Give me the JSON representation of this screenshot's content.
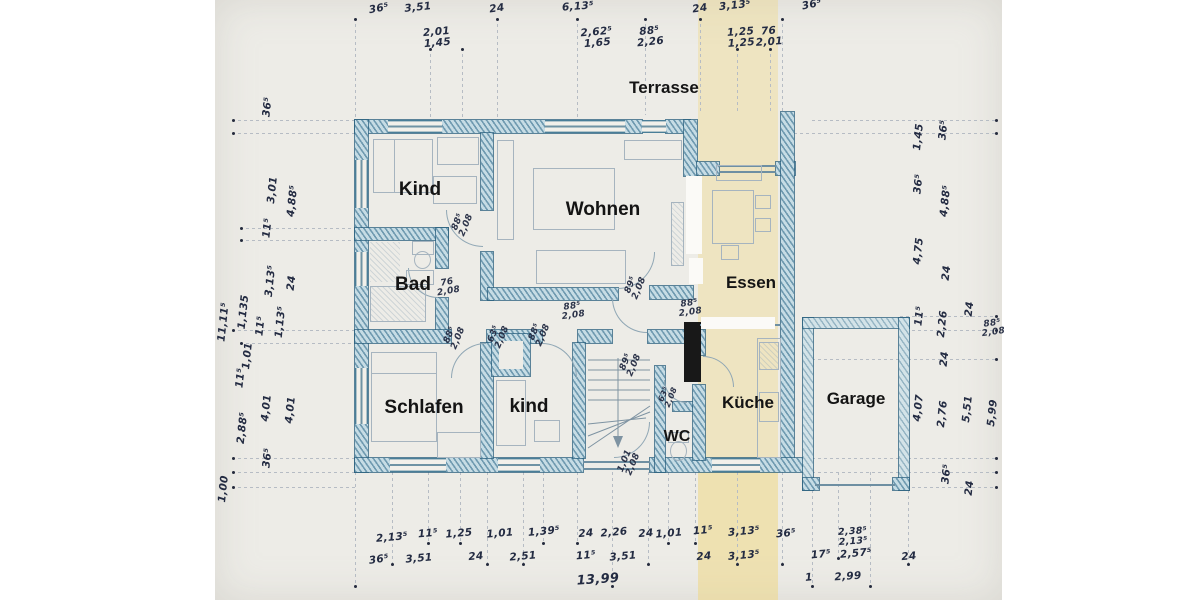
{
  "document_type": "scanned hand-drawn floor plan",
  "colors": {
    "paper": "#edece7",
    "margin": "#ffffff",
    "wall_ink": "#2f6b8a",
    "wall_fill": "#cfe0e8",
    "handwriting_ink": "#232b42",
    "pencil": "#a6b4bf",
    "room_text": "#141414",
    "highlight_strip": "#eed884",
    "chimney": "#181818"
  },
  "labels": {
    "rooms": [
      {
        "id": "terrasse",
        "t": "Terrasse",
        "x": 664,
        "y": 88,
        "s": 17
      },
      {
        "id": "kind-1",
        "t": "Kind",
        "x": 420,
        "y": 190,
        "s": 19
      },
      {
        "id": "wohnen",
        "t": "Wohnen",
        "x": 603,
        "y": 210,
        "s": 19
      },
      {
        "id": "essen",
        "t": "Essen",
        "x": 751,
        "y": 283,
        "s": 17
      },
      {
        "id": "bad",
        "t": "Bad",
        "x": 413,
        "y": 285,
        "s": 19
      },
      {
        "id": "schlafen",
        "t": "Schlafen",
        "x": 424,
        "y": 408,
        "s": 19
      },
      {
        "id": "kind-2",
        "t": "kind",
        "x": 529,
        "y": 407,
        "s": 19
      },
      {
        "id": "wc",
        "t": "WC",
        "x": 677,
        "y": 437,
        "s": 16
      },
      {
        "id": "kueche",
        "t": "Küche",
        "x": 748,
        "y": 403,
        "s": 17
      },
      {
        "id": "garage",
        "t": "Garage",
        "x": 856,
        "y": 399,
        "s": 17
      }
    ],
    "dims": [
      {
        "t": "36⁵",
        "x": 379,
        "y": 9,
        "r": -10
      },
      {
        "t": "3,51",
        "x": 418,
        "y": 8,
        "r": -6
      },
      {
        "t": "24",
        "x": 497,
        "y": 9,
        "r": -8
      },
      {
        "t": "6,13⁵",
        "x": 578,
        "y": 7,
        "r": -4
      },
      {
        "t": "24",
        "x": 700,
        "y": 9,
        "r": -8
      },
      {
        "t": "3,13⁵",
        "x": 735,
        "y": 6,
        "r": -6
      },
      {
        "t": "36⁵",
        "x": 812,
        "y": 5,
        "r": -12
      },
      {
        "t": "2,01\n1,45",
        "x": 437,
        "y": 38,
        "r": -5
      },
      {
        "t": "2,62⁵\n1,65",
        "x": 597,
        "y": 38,
        "r": -5
      },
      {
        "t": "88⁵\n2,26",
        "x": 650,
        "y": 37,
        "r": -6
      },
      {
        "t": "1,25\n1,25",
        "x": 741,
        "y": 38,
        "r": -4
      },
      {
        "t": "76\n2,01",
        "x": 769,
        "y": 37,
        "r": -4
      },
      {
        "t": "36⁵",
        "x": 268,
        "y": 107,
        "r": -84
      },
      {
        "t": "3,01",
        "x": 273,
        "y": 190,
        "r": -84
      },
      {
        "t": "4,88⁵",
        "x": 293,
        "y": 201,
        "r": -84
      },
      {
        "t": "11⁵",
        "x": 268,
        "y": 228,
        "r": -84
      },
      {
        "t": "3,13⁵",
        "x": 271,
        "y": 281,
        "r": -84
      },
      {
        "t": "24",
        "x": 292,
        "y": 283,
        "r": -84
      },
      {
        "t": "11,11⁵",
        "x": 224,
        "y": 322,
        "r": -84
      },
      {
        "t": "1,135",
        "x": 244,
        "y": 312,
        "r": -84
      },
      {
        "t": "11⁵",
        "x": 261,
        "y": 326,
        "r": -84
      },
      {
        "t": "1,13⁵",
        "x": 281,
        "y": 322,
        "r": -84
      },
      {
        "t": "1,01",
        "x": 248,
        "y": 356,
        "r": -84
      },
      {
        "t": "11⁵",
        "x": 241,
        "y": 378,
        "r": -84
      },
      {
        "t": "2,88⁵",
        "x": 243,
        "y": 428,
        "r": -84
      },
      {
        "t": "4,01",
        "x": 267,
        "y": 408,
        "r": -84
      },
      {
        "t": "4,01",
        "x": 291,
        "y": 410,
        "r": -84
      },
      {
        "t": "36⁵",
        "x": 268,
        "y": 458,
        "r": -84
      },
      {
        "t": "1,00",
        "x": 224,
        "y": 489,
        "r": -84
      },
      {
        "t": "1,45",
        "x": 919,
        "y": 137,
        "r": -84
      },
      {
        "t": "36⁵",
        "x": 944,
        "y": 130,
        "r": -84
      },
      {
        "t": "36⁵",
        "x": 919,
        "y": 184,
        "r": -84
      },
      {
        "t": "4,88⁵",
        "x": 946,
        "y": 201,
        "r": -84
      },
      {
        "t": "4,75",
        "x": 919,
        "y": 251,
        "r": -84
      },
      {
        "t": "24",
        "x": 947,
        "y": 273,
        "r": -84
      },
      {
        "t": "11⁵",
        "x": 920,
        "y": 316,
        "r": -84
      },
      {
        "t": "2,26",
        "x": 943,
        "y": 324,
        "r": -84
      },
      {
        "t": "24",
        "x": 970,
        "y": 309,
        "r": -84
      },
      {
        "t": "24",
        "x": 945,
        "y": 359,
        "r": -84
      },
      {
        "t": "4,07",
        "x": 919,
        "y": 408,
        "r": -84
      },
      {
        "t": "2,76",
        "x": 943,
        "y": 414,
        "r": -84
      },
      {
        "t": "5,51",
        "x": 968,
        "y": 409,
        "r": -84
      },
      {
        "t": "5,99",
        "x": 993,
        "y": 413,
        "r": -84
      },
      {
        "t": "36⁵",
        "x": 947,
        "y": 474,
        "r": -84
      },
      {
        "t": "24",
        "x": 970,
        "y": 488,
        "r": -84
      },
      {
        "t": "2,13⁵",
        "x": 392,
        "y": 538,
        "r": -5
      },
      {
        "t": "11⁵",
        "x": 428,
        "y": 534,
        "r": -5
      },
      {
        "t": "1,25",
        "x": 459,
        "y": 534,
        "r": -5
      },
      {
        "t": "1,01",
        "x": 500,
        "y": 534,
        "r": -5
      },
      {
        "t": "1,39⁵",
        "x": 544,
        "y": 532,
        "r": -5
      },
      {
        "t": "24",
        "x": 586,
        "y": 534,
        "r": -5
      },
      {
        "t": "2,26",
        "x": 614,
        "y": 533,
        "r": -5
      },
      {
        "t": "24",
        "x": 646,
        "y": 534,
        "r": -5
      },
      {
        "t": "1,01",
        "x": 669,
        "y": 534,
        "r": -5
      },
      {
        "t": "11⁵",
        "x": 703,
        "y": 531,
        "r": -5
      },
      {
        "t": "3,13⁵",
        "x": 744,
        "y": 532,
        "r": -5
      },
      {
        "t": "36⁵",
        "x": 786,
        "y": 534,
        "r": -5
      },
      {
        "t": "2,38⁵\n2,13⁵",
        "x": 853,
        "y": 537,
        "r": -4,
        "s": 9.5
      },
      {
        "t": "36⁵",
        "x": 379,
        "y": 560,
        "r": -8
      },
      {
        "t": "3,51",
        "x": 419,
        "y": 559,
        "r": -5
      },
      {
        "t": "24",
        "x": 476,
        "y": 557,
        "r": -5
      },
      {
        "t": "2,51",
        "x": 523,
        "y": 557,
        "r": -5
      },
      {
        "t": "11⁵",
        "x": 586,
        "y": 556,
        "r": -5
      },
      {
        "t": "3,51",
        "x": 623,
        "y": 557,
        "r": -5
      },
      {
        "t": "24",
        "x": 704,
        "y": 557,
        "r": -5
      },
      {
        "t": "3,13⁵",
        "x": 744,
        "y": 556,
        "r": -5
      },
      {
        "t": "17⁵",
        "x": 821,
        "y": 555,
        "r": -5
      },
      {
        "t": "2,57⁵",
        "x": 856,
        "y": 554,
        "r": -5
      },
      {
        "t": "24",
        "x": 909,
        "y": 557,
        "r": -5
      },
      {
        "t": "13,99",
        "x": 598,
        "y": 580,
        "r": -4,
        "s": 13
      },
      {
        "t": "1",
        "x": 809,
        "y": 578,
        "r": -5
      },
      {
        "t": "2,99",
        "x": 848,
        "y": 577,
        "r": -4
      }
    ],
    "doors": [
      {
        "t": "88⁵\n2,08",
        "x": 463,
        "y": 224,
        "r": -68
      },
      {
        "t": "76\n2,08",
        "x": 448,
        "y": 288,
        "r": -10
      },
      {
        "t": "88⁵\n2,08",
        "x": 573,
        "y": 312,
        "r": -8
      },
      {
        "t": "89⁵\n2,08",
        "x": 636,
        "y": 287,
        "r": -68
      },
      {
        "t": "88⁵\n2,08",
        "x": 690,
        "y": 309,
        "r": -8
      },
      {
        "t": "88⁵\n2,08",
        "x": 455,
        "y": 337,
        "r": -68
      },
      {
        "t": "63⁵\n2,08",
        "x": 499,
        "y": 336,
        "r": -68
      },
      {
        "t": "88⁵\n2,08",
        "x": 540,
        "y": 334,
        "r": -68
      },
      {
        "t": "89⁵\n2,08",
        "x": 631,
        "y": 364,
        "r": -68
      },
      {
        "t": "63⁵\n2,08",
        "x": 668,
        "y": 396,
        "r": -68,
        "tiny": true
      },
      {
        "t": "1,01\n2,08",
        "x": 630,
        "y": 463,
        "r": -68
      },
      {
        "t": "88⁵\n2,08",
        "x": 993,
        "y": 329,
        "r": -8
      }
    ]
  }
}
